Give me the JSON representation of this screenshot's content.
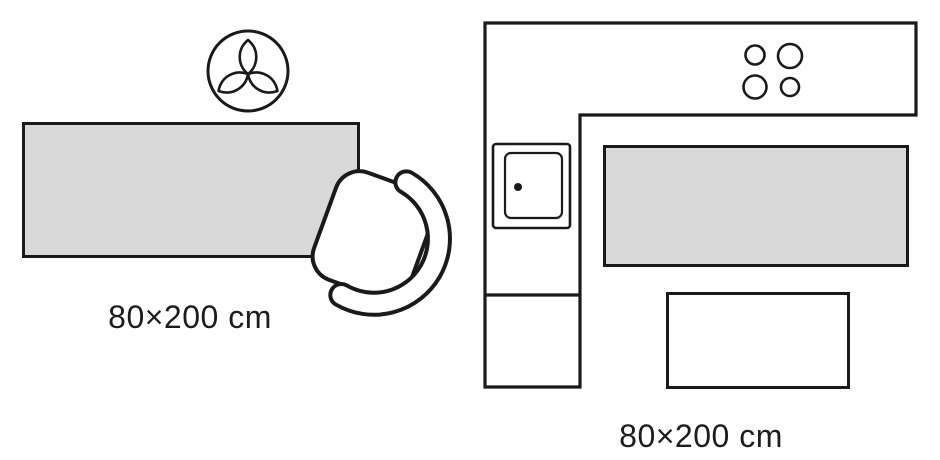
{
  "page": {
    "background_color": "#ffffff",
    "line_color": "#1a1a1a",
    "rug_fill_color": "#d9d9d9",
    "description": "Rug size placement diagram, two scenes"
  },
  "rug_size": {
    "width_cm": 80,
    "length_cm": 200
  },
  "left_scene": {
    "name": "living-area scene with runner rug, plant and armchair",
    "label": "80×200 cm",
    "icons": [
      "plant-icon",
      "armchair-icon",
      "runner-rug"
    ]
  },
  "right_scene": {
    "name": "kitchen floor plan with runner rug and table",
    "label": "80×200 cm",
    "icons": [
      "kitchen-counter-outline",
      "stove-burners-icon",
      "sink-icon",
      "runner-rug",
      "table-outline"
    ]
  }
}
